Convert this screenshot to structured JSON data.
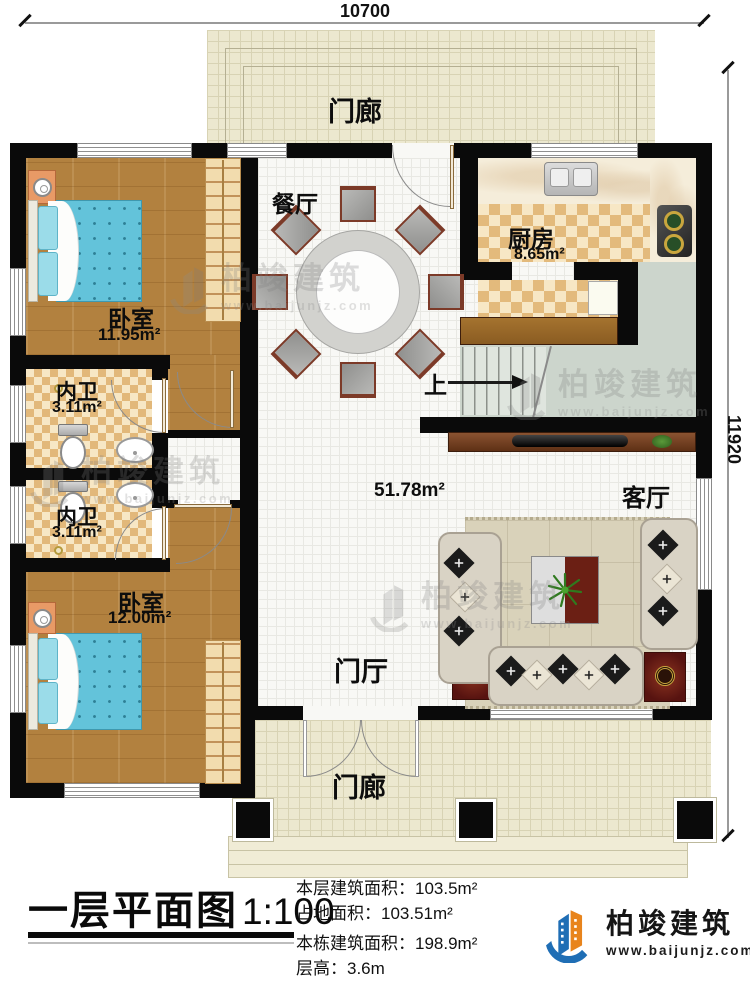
{
  "dimensions": {
    "width": "10700",
    "height": "11920"
  },
  "labels": {
    "porch_top": "门廊",
    "porch_bottom": "门廊",
    "dining": "餐厅",
    "kitchen": "厨房",
    "kitchen_area": "8.65m²",
    "bedroom1": "卧室",
    "bedroom1_area": "11.95m²",
    "bath1": "内卫",
    "bath1_area": "3.11m²",
    "bath2": "内卫",
    "bath2_area": "3.11m²",
    "bedroom2": "卧室",
    "bedroom2_area": "12.00m²",
    "living": "客厅",
    "hall_area": "51.78m²",
    "foyer": "门厅",
    "stairs_up": "上"
  },
  "title_block": {
    "title": "一层平面图",
    "scale": "1:100",
    "info": [
      {
        "label": "本层建筑面积：",
        "value": "103.5m²"
      },
      {
        "label": "占地面积：",
        "value": "103.51m²"
      },
      {
        "label": "本栋建筑面积：",
        "value": "198.9m²"
      },
      {
        "label": "层高：",
        "value": "3.6m"
      }
    ]
  },
  "logo": {
    "name": "柏竣建筑",
    "url": "www.baijunjz.com"
  },
  "watermark": {
    "brand": "柏竣建筑",
    "url": "www.baijunjz.com"
  },
  "colors": {
    "wall": "#0a0a0a",
    "logo_blue": "#1f6eb5",
    "logo_orange": "#e8841c",
    "wood": "#b2813f",
    "bed": "#63c3da"
  }
}
